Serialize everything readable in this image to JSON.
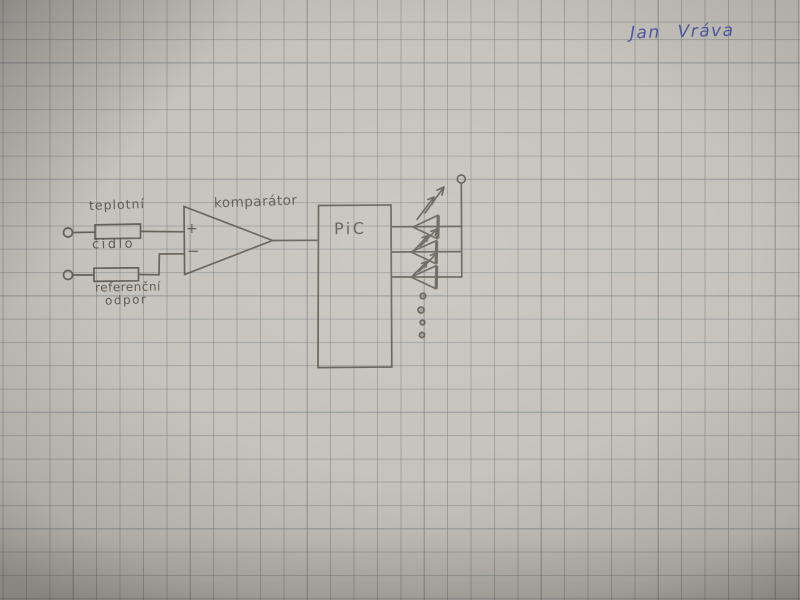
{
  "signature": {
    "name": "Jan Vráva",
    "ink_color": "#4751a8"
  },
  "diagram": {
    "labels": {
      "sensor_line1": "teplotní",
      "sensor_line2": "čidlo",
      "reference_line1": "referenční",
      "reference_line2": "odpor",
      "comparator": "komparátor",
      "comparator_plus": "+",
      "comparator_minus": "−",
      "mcu": "PiC"
    },
    "colors": {
      "paper": "#c6c3bc",
      "grid_line": "#a3a7a8",
      "pencil": "#57544b",
      "pen_blue": "#4751a8"
    }
  }
}
